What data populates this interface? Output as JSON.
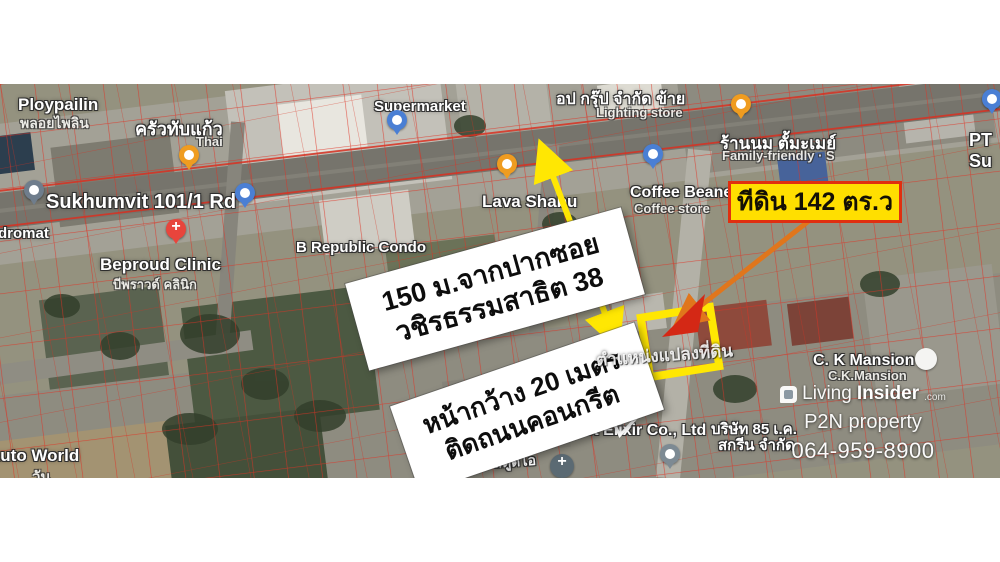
{
  "annotations": {
    "land_area_badge": "ทีดิน 142 ตร.ว",
    "distance_label": {
      "line1": "150 ม.จากปากซอย",
      "line2": "วชิรธรรมสาธิต 38"
    },
    "frontage_label": {
      "line1": "หน้ากว้าง 20 เมตร",
      "line2": "ติดถนนคอนกรีต"
    },
    "plot_position_watermark": "ตำแหน่งแปลงที่ดิน"
  },
  "map_labels": {
    "ploypailin": {
      "name": "Ploypailin",
      "name_th": "พลอยไพลิน"
    },
    "krua_thap_kaew": {
      "name_th": "ครัวทับแก้ว",
      "category": "Thai"
    },
    "sukhumvit_road": {
      "name": "Sukhumvit 101/1 Rd"
    },
    "laundromat_partial": {
      "name": "dromat"
    },
    "beproud_clinic": {
      "name": "Beproud Clinic",
      "name_th": "บีพราวด์ คลินิก"
    },
    "b_republic_condo": {
      "name": "B Republic Condo"
    },
    "supermarket": {
      "name": "Supermarket"
    },
    "lava_shabu": {
      "name": "Lava Shabu"
    },
    "op_group": {
      "name_th": "อป กรุ๊ป จำกัด ข้าย",
      "category": "Lighting store"
    },
    "milk_shop": {
      "name_th": "ร้านนม ตั้มะเมย์",
      "category": "Family-friendly · S"
    },
    "coffee_beane": {
      "name": "Coffee Beane",
      "category": "Coffee store"
    },
    "ck_mansion": {
      "name": "C. K Mansion",
      "name_alt": "C.K.Mansion"
    },
    "best_elixir": {
      "name": "Best Elixir Co., Ltd"
    },
    "company_85": {
      "line1": "บริษัท 85 เ.ค.",
      "line2": "สกรีน จำกัด"
    },
    "house_no": {
      "line1": "นเลขที่",
      "line2": "10 สตูดิโอ"
    },
    "auto_world": {
      "name": "Auto World",
      "name_th": "วัน"
    },
    "pt_partial": {
      "line1": "PT",
      "line2": "Su"
    }
  },
  "watermark": {
    "brand_prefix": "Living",
    "brand_suffix": "Insider",
    "brand_tld": ".com",
    "agency": "P2N property",
    "phone": "064-959-8900"
  },
  "colors": {
    "highlight_yellow": "#ffe703",
    "badge_background": "#ffdf00",
    "badge_border_red": "#e02f10",
    "parcel_line_red": "#e03224",
    "orange_arrow": "#e0761c",
    "white_arrow": "#ffffff"
  },
  "icons": {
    "restaurant-pin": "orange teardrop",
    "shopping-pin": "blue teardrop",
    "clinic-pin": "red teardrop with cross",
    "laundromat-pin": "slate teardrop",
    "place-pin": "gray teardrop",
    "church-pin": "dark circle with cross",
    "mansion-pin": "white circle",
    "brand-logo": "white rounded square"
  }
}
